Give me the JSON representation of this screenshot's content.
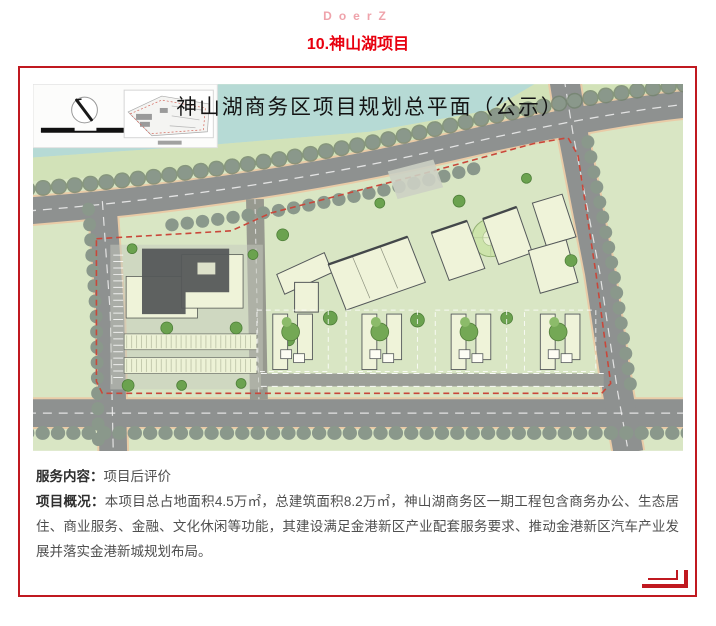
{
  "page": {
    "brand": "DoerZ",
    "title": "10.神山湖项目"
  },
  "map": {
    "title": "神山湖商务区项目规划总平面（公示）"
  },
  "details": {
    "service_label": "服务内容：",
    "service_value": "项目后评价",
    "overview_label": "项目概况：",
    "overview_value": "本项目总占地面积4.5万㎡，总建筑面积8.2万㎡，神山湖商务区一期工程包含商务办公、生态居住、商业服务、金融、文化休闲等功能，其建设满足金港新区产业配套服务要求、推动金港新区汽车产业发展并落实金港新城规划布局。"
  },
  "colors": {
    "frame_red": "#c01920",
    "title_red": "#e8000f",
    "brand_pink": "#efa3ab",
    "water": "#b6dad5",
    "field_green": "#d9e6c4",
    "road_gray": "#8e9190",
    "building_cream": "#eff3d9",
    "boundary_red_dash": "#c9473a"
  }
}
